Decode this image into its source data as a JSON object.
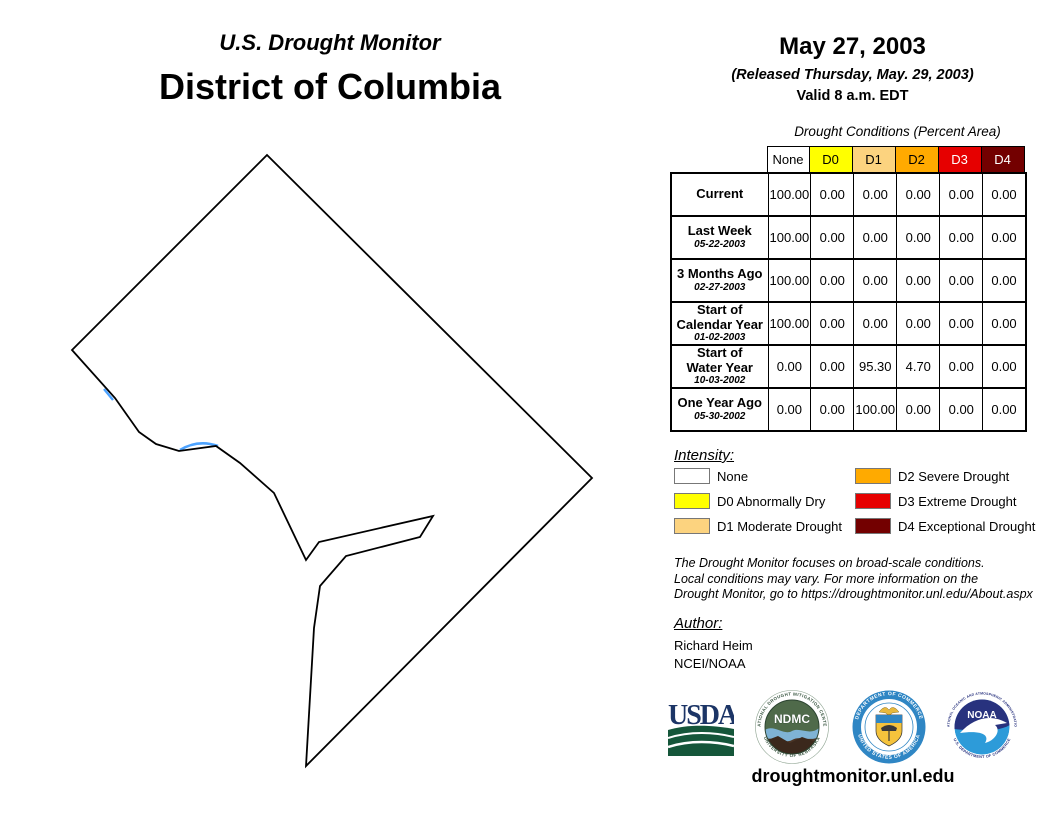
{
  "header": {
    "program": "U.S. Drought Monitor",
    "region": "District of Columbia",
    "date": "May 27, 2003",
    "released": "(Released Thursday, May. 29, 2003)",
    "valid": "Valid 8 a.m. EDT"
  },
  "table": {
    "caption": "Drought Conditions (Percent Area)",
    "columns": [
      {
        "label": "None",
        "bg": "#FFFFFF",
        "fg": "#000000"
      },
      {
        "label": "D0",
        "bg": "#FFFF00",
        "fg": "#000000"
      },
      {
        "label": "D1",
        "bg": "#FCD37F",
        "fg": "#000000"
      },
      {
        "label": "D2",
        "bg": "#FFAA00",
        "fg": "#000000"
      },
      {
        "label": "D3",
        "bg": "#E60000",
        "fg": "#FFFFFF"
      },
      {
        "label": "D4",
        "bg": "#730000",
        "fg": "#FFFFFF"
      }
    ],
    "rows": [
      {
        "label": "Current",
        "date": "",
        "values": [
          "100.00",
          "0.00",
          "0.00",
          "0.00",
          "0.00",
          "0.00"
        ]
      },
      {
        "label": "Last Week",
        "date": "05-22-2003",
        "values": [
          "100.00",
          "0.00",
          "0.00",
          "0.00",
          "0.00",
          "0.00"
        ]
      },
      {
        "label": "3 Months Ago",
        "date": "02-27-2003",
        "values": [
          "100.00",
          "0.00",
          "0.00",
          "0.00",
          "0.00",
          "0.00"
        ]
      },
      {
        "label": "Start of\nCalendar Year",
        "date": "01-02-2003",
        "values": [
          "100.00",
          "0.00",
          "0.00",
          "0.00",
          "0.00",
          "0.00"
        ]
      },
      {
        "label": "Start of\nWater Year",
        "date": "10-03-2002",
        "values": [
          "0.00",
          "0.00",
          "95.30",
          "4.70",
          "0.00",
          "0.00"
        ]
      },
      {
        "label": "One Year Ago",
        "date": "05-30-2002",
        "values": [
          "0.00",
          "0.00",
          "100.00",
          "0.00",
          "0.00",
          "0.00"
        ]
      }
    ]
  },
  "legend": {
    "title": "Intensity:",
    "items": [
      {
        "label": "None",
        "color": "#FFFFFF"
      },
      {
        "label": "D0 Abnormally Dry",
        "color": "#FFFF00"
      },
      {
        "label": "D1 Moderate Drought",
        "color": "#FCD37F"
      },
      {
        "label": "D2 Severe Drought",
        "color": "#FFAA00"
      },
      {
        "label": "D3 Extreme Drought",
        "color": "#E60000"
      },
      {
        "label": "D4 Exceptional Drought",
        "color": "#730000"
      }
    ]
  },
  "disclaimer": "The Drought Monitor focuses on broad-scale conditions.\nLocal conditions may vary. For more information on the\nDrought Monitor, go to https://droughtmonitor.unl.edu/About.aspx",
  "author": {
    "title": "Author:",
    "name": "Richard Heim",
    "org": "NCEI/NOAA"
  },
  "logos": {
    "usda": {
      "text": "USDA"
    },
    "ndmc": {
      "text": "NDMC",
      "ring_top": "NATIONAL DROUGHT MITIGATION CENTER",
      "ring_bottom": "UNIVERSITY OF NEBRASKA"
    },
    "commerce": {
      "ring_top": "DEPARTMENT OF COMMERCE",
      "ring_bottom": "UNITED STATES OF AMERICA"
    },
    "noaa": {
      "text": "NOAA",
      "ring_top": "NATIONAL OCEANIC AND ATMOSPHERIC ADMINISTRATION",
      "ring_bottom": "U.S. DEPARTMENT OF COMMERCE"
    }
  },
  "footer": {
    "url": "droughtmonitor.unl.edu"
  },
  "chart_data": {
    "type": "table",
    "title": "Drought Conditions (Percent Area)",
    "categories": [
      "None",
      "D0",
      "D1",
      "D2",
      "D3",
      "D4"
    ],
    "series": [
      {
        "name": "Current",
        "values": [
          100.0,
          0.0,
          0.0,
          0.0,
          0.0,
          0.0
        ]
      },
      {
        "name": "Last Week (05-22-2003)",
        "values": [
          100.0,
          0.0,
          0.0,
          0.0,
          0.0,
          0.0
        ]
      },
      {
        "name": "3 Months Ago (02-27-2003)",
        "values": [
          100.0,
          0.0,
          0.0,
          0.0,
          0.0,
          0.0
        ]
      },
      {
        "name": "Start of Calendar Year (01-02-2003)",
        "values": [
          100.0,
          0.0,
          0.0,
          0.0,
          0.0,
          0.0
        ]
      },
      {
        "name": "Start of Water Year (10-03-2002)",
        "values": [
          0.0,
          0.0,
          95.3,
          4.7,
          0.0,
          0.0
        ]
      },
      {
        "name": "One Year Ago (05-30-2002)",
        "values": [
          0.0,
          0.0,
          100.0,
          0.0,
          0.0,
          0.0
        ]
      }
    ]
  }
}
